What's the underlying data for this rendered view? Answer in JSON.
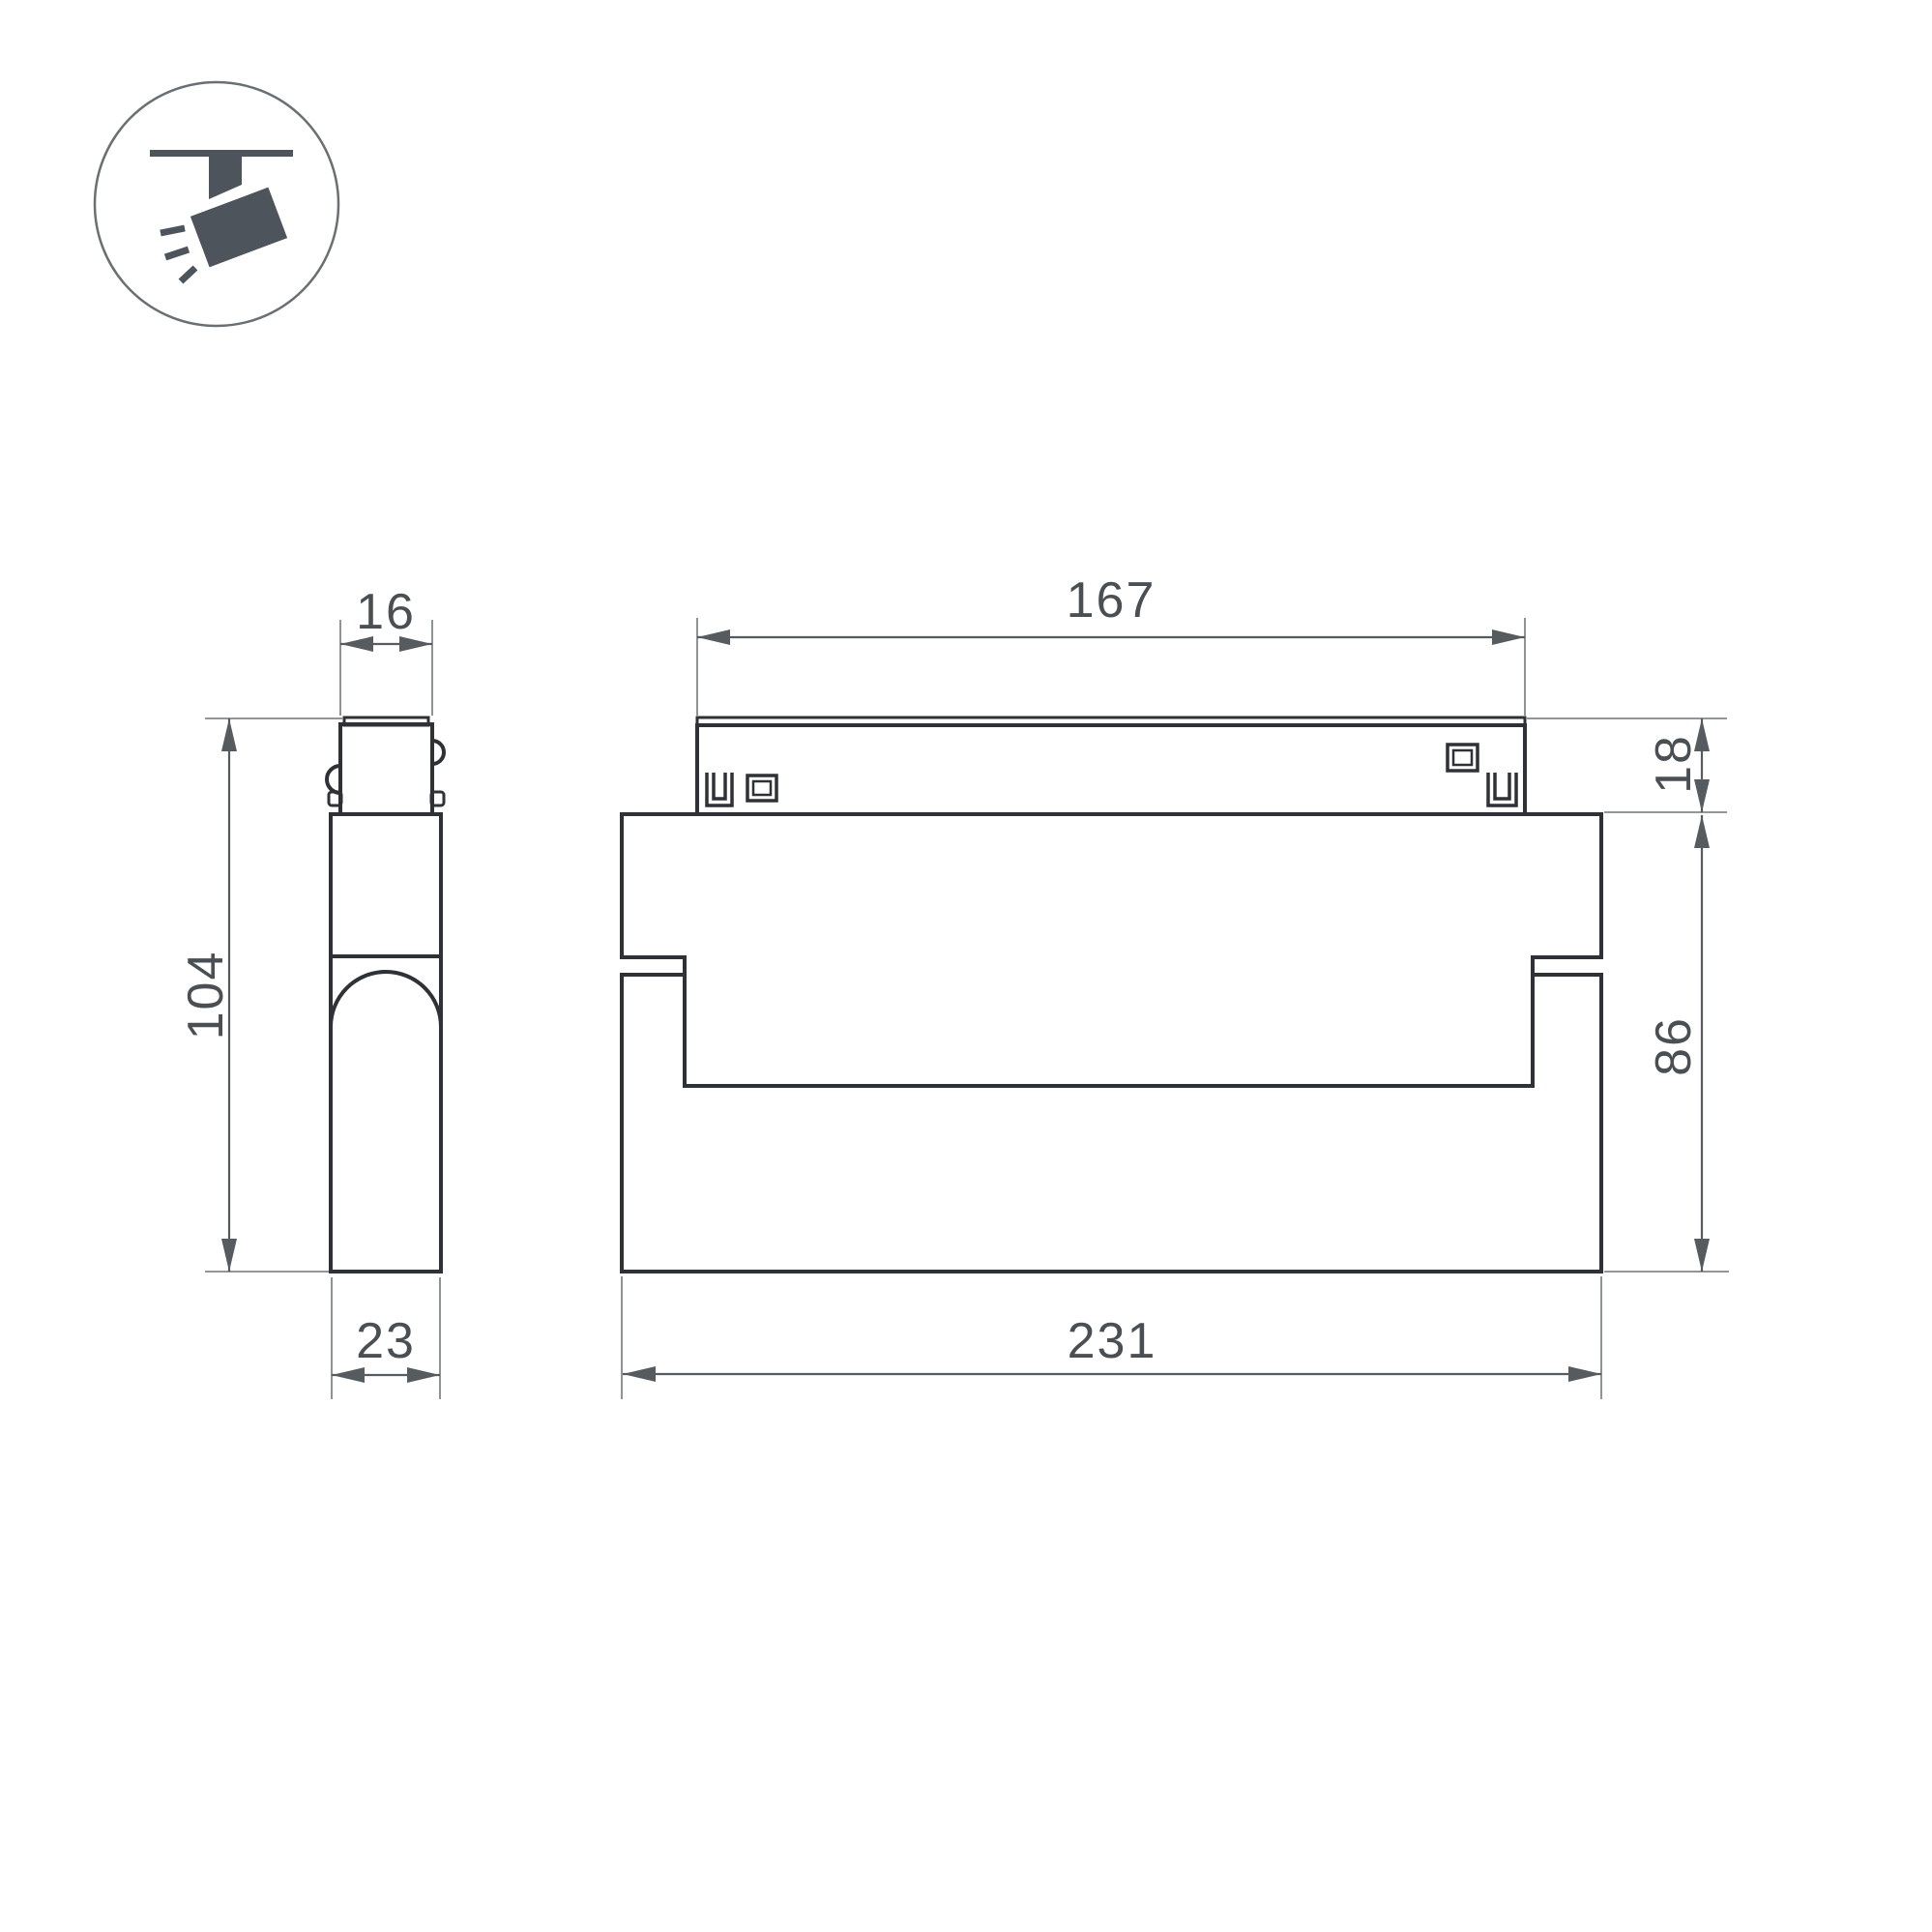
{
  "colors": {
    "outline": "#2e3135",
    "dimension": "#565b5f",
    "extension": "#82878b",
    "text": "#4a4f54",
    "icon": "#4d545b",
    "icon_circle": "#6a6f73"
  },
  "icon": {
    "name": "ceiling-track-spotlight"
  },
  "views": {
    "side": {
      "dims": {
        "width_top": "16",
        "height": "104",
        "depth": "23"
      }
    },
    "front": {
      "dims": {
        "track_length": "167",
        "track_height": "18",
        "body_height": "86",
        "body_length": "231"
      }
    }
  }
}
